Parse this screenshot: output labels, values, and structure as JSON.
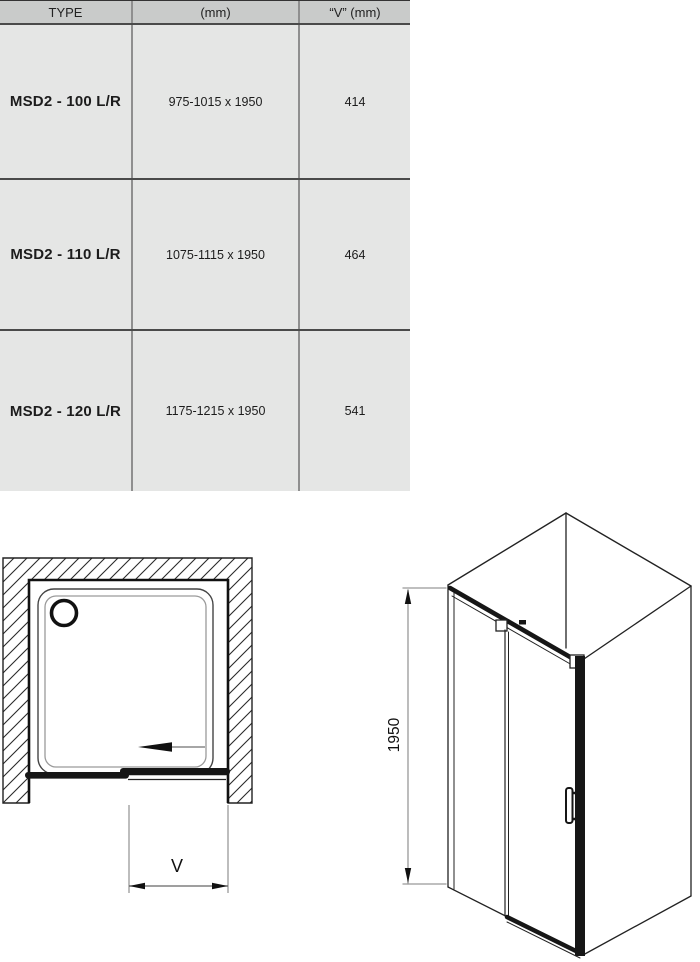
{
  "table": {
    "headers": [
      "TYPE",
      "(mm)",
      "“V” (mm)"
    ],
    "rows": [
      {
        "type": "MSD2 - 100 L/R",
        "size_mm": "975-1015 x 1950",
        "v_mm": "414"
      },
      {
        "type": "MSD2 - 110 L/R",
        "size_mm": "1075-1115 x 1950",
        "v_mm": "464"
      },
      {
        "type": "MSD2 - 120 L/R",
        "size_mm": "1175-1215 x 1950",
        "v_mm": "541"
      }
    ]
  },
  "diagrams": {
    "plan_view": {
      "dimension_label": "V"
    },
    "isometric_view": {
      "height_label": "1950"
    }
  },
  "colors": {
    "header_bg": "#c9cbca",
    "row_bg": "#e5e6e5",
    "separator_dark": "#4a4a4a",
    "separator_mid": "#8f8f8f",
    "ink": "#161616",
    "dimension_gray": "#999999"
  }
}
